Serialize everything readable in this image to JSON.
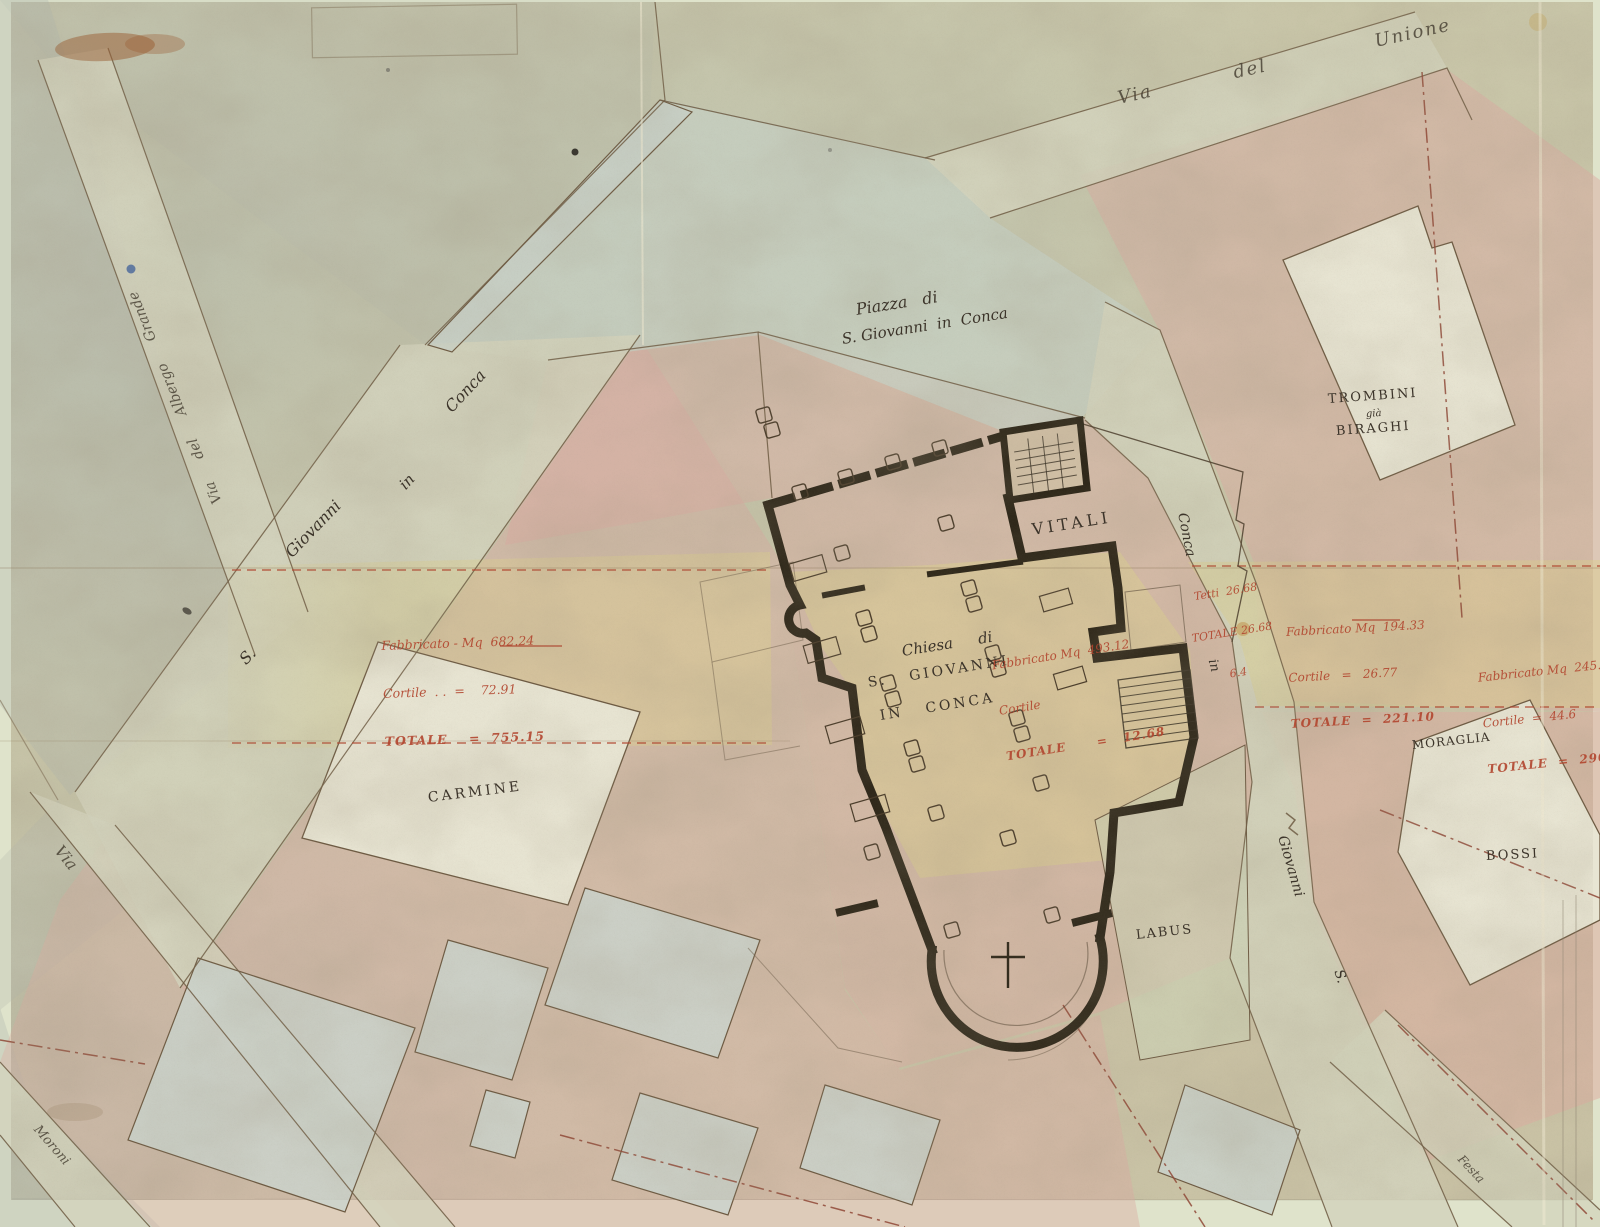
{
  "map": {
    "streets": {
      "via_del_unione": "Via   del    Unione",
      "piazza_line1": "Piazza   di",
      "piazza_line2": "S. Giovanni  in  Conca",
      "sgc_conca": "Conca",
      "sgc_in": "in",
      "sgc_giovanni": "Giovanni",
      "sgc_s": "S.",
      "via_albergo": "Via  del  Albergo  Grande",
      "conca_st_conca": "Conca",
      "conca_st_in": "in",
      "conca_st_giovanni": "Giovanni",
      "conca_st_s": "S.",
      "via_sw": "Via",
      "moroni": "Moroni",
      "festa": "Festa"
    },
    "properties": {
      "vitali": "VITALI",
      "trombini_1": "TROMBINI",
      "trombini_2": "già",
      "trombini_3": "BIRAGHI",
      "chiesa_1": "Chiesa  di",
      "chiesa_2": "S.   GIOVANNI",
      "chiesa_3": "IN   CONCA",
      "carmine": "CARMINE",
      "moraglia": "MORAGLIA",
      "bossi": "BOSSI",
      "labus": "LABUS"
    },
    "annotations": {
      "west_parcel": {
        "l1": "Fabbricato - Mq  682.24",
        "l2": "Cortile  . .  =    72.91",
        "l3": "TOTALE    =  755.15"
      },
      "vitali_parcel": {
        "l1": "Tetti  26.68",
        "l2": "TOTALE 26.68",
        "l3": "6.4"
      },
      "church_parcel": {
        "l1": "Fabbricato Mq  493.12",
        "l2": "Cortile",
        "l3": "TOTALE      =   12.68"
      },
      "east_parcel": {
        "l1": "Fabbricato Mq  194.33",
        "l2": "Cortile   =   26.77",
        "l3": "TOTALE  =  221.10"
      },
      "far_east_parcel": {
        "l1": "Fabbricato Mq  245.6",
        "l2": "Cortile  =  44.6",
        "l3": "TOTALE  =  290.2"
      }
    },
    "colors": {
      "paper": "#cac7aa",
      "mat": "#dfe3cb",
      "pink_wash": "#dcaea3",
      "yellow_wash": "#dccf8f",
      "street_wash": "#d3d4bd",
      "piazza_wash": "#c6cfc3",
      "blue_building": "#cbd4cc",
      "white_building": "#e8e5d3",
      "ink": "#3c342a",
      "red_ink": "#b2452e",
      "wall_ink": "#2e2719"
    }
  }
}
